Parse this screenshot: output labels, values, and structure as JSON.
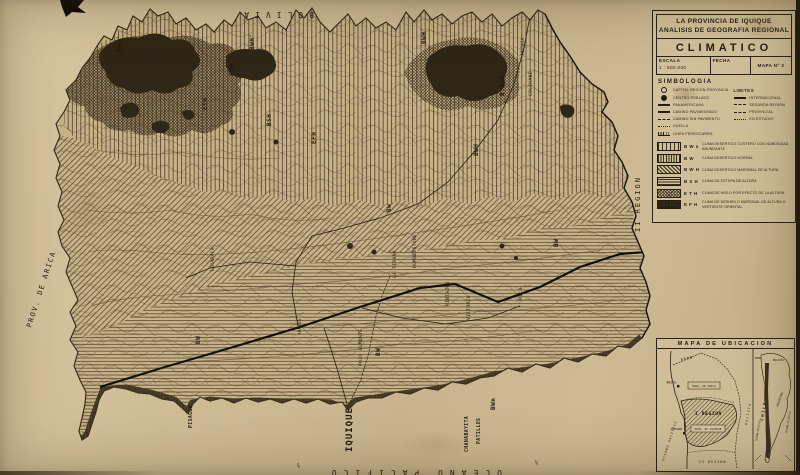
{
  "colors": {
    "paper": "#cfbd96",
    "ink": "#241c10",
    "zone_dark": "#2f2517",
    "hatch": "#4a3c28"
  },
  "title_block": {
    "line1": "LA PROVINCIA DE IQUIQUE",
    "line2": "ANALISIS DE GEOGRAFIA REGIONAL",
    "subject": "CLIMATICO",
    "escala_label": "ESCALA",
    "escala_value": "1 : 500.000",
    "fecha_label": "FECHA",
    "mapa_label": "MAPA Nº 3"
  },
  "simbologia": {
    "title": "SIMBOLOGIA",
    "left": [
      {
        "label": "CAPITAL REGION-PROVINCIA"
      },
      {
        "label": "CENTRO POBLADO"
      },
      {
        "label": "PANAMERICANA"
      },
      {
        "label": "CAMINO PAVIMENTADO"
      },
      {
        "label": "CAMINO SIN PAVIMENTO"
      },
      {
        "label": "HUELLA"
      },
      {
        "label": "LINEA FERROCARRIL"
      }
    ],
    "limites_title": "LIMITES",
    "limites": [
      {
        "label": "INTERNACIONAL"
      },
      {
        "label": "SEGUNDA REGION"
      },
      {
        "label": "PROVINCIAL"
      },
      {
        "label": "EN ESTUDIO"
      }
    ]
  },
  "legend": {
    "items": [
      {
        "code": "B W n",
        "label": "CLIMA DESERTICO COSTERO CON NUBOSIDAD ABUNDANTE"
      },
      {
        "code": "B W",
        "label": "CLIMA DESERTICO NORMAL"
      },
      {
        "code": "B W H",
        "label": "CLIMA DESERTICO MARGINAL DE ALTURA"
      },
      {
        "code": "B S H",
        "label": "CLIMA DE ESTEPA DE ALTURA"
      },
      {
        "code": "E T H",
        "label": "CLIMA DE HIELO POR EFECTO DE LA ALTURA"
      },
      {
        "code": "E F H",
        "label": "CLIMA DE DESHIELO MARGINAL DE ALTURA O VERTIENTE ORIENTAL"
      }
    ]
  },
  "map": {
    "edge": {
      "bolivia": "BOLIVIA",
      "prov_arica": "PROV. DE ARICA",
      "region_ii": "II REGION",
      "iquique": "IQUIQUE",
      "oceano": "OCEANO PACIFICO",
      "fold_mark": "½"
    },
    "zone_labels": [
      "BWH'",
      "BWH'",
      "BWH'",
      "EFH",
      "ETH",
      "BSH",
      "EFH",
      "B.S.H",
      "BWH",
      "BW",
      "BW",
      "BW",
      "BW",
      "BWn"
    ],
    "towns": [
      "ISLUGA",
      "COLCHANE",
      "TARAPACA",
      "HUARA",
      "POZO ALMONTE",
      "HUMBERSTONE",
      "LA TIRANA",
      "PINTADOS",
      "VICTORIA",
      "PICA"
    ],
    "coast_towns": [
      "PISAGUA",
      "CHANABAYITA",
      "PATILLOS"
    ]
  },
  "inset": {
    "title": "MAPA DE UBICACION",
    "left": {
      "peru": "PERU",
      "arica": "ARICA",
      "prov_arica": "PROV. DE ARICA",
      "region_i": "I REGION",
      "iquique": "IQUIQUE",
      "prov_iquique": "PROV. DE IQUIQUE",
      "region_ii": "II REGION",
      "oceano": "OCEANO PACIFICO",
      "bolivia": "BOLIVIA"
    },
    "right": {
      "peru": "PERU",
      "bolivia": "BOLIVIA",
      "chile": "CHILE",
      "argentina": "ARGENTINA",
      "atlantico": "OCEANO ATLANTICO",
      "pacifico": "OCEANO PACIFICO"
    }
  }
}
